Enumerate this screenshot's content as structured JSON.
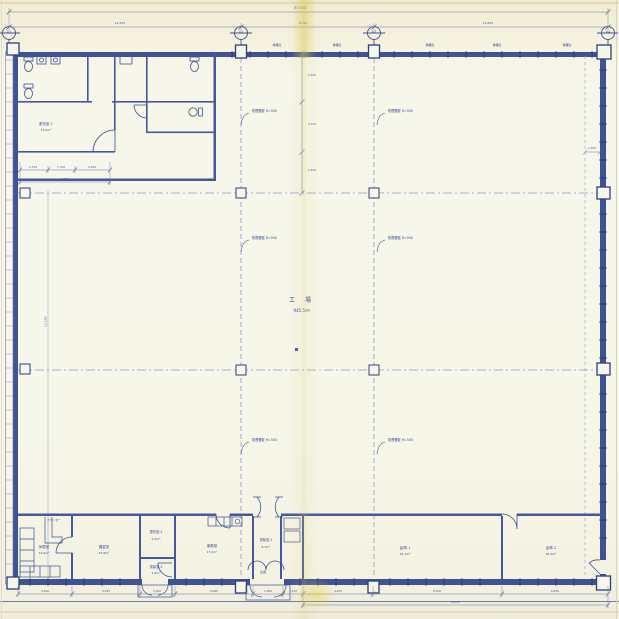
{
  "sheet": {
    "paper_color": "#f6f4e6",
    "ink_color": "#3e5094",
    "wall_color": "#3f5292"
  },
  "grid": {
    "bubbles": [
      {
        "label": "X1"
      },
      {
        "label": "X2"
      },
      {
        "label": "X3"
      },
      {
        "label": "X4"
      }
    ]
  },
  "dims": {
    "overall": "37,540",
    "top": [
      "14,550",
      "8,340",
      "14,650"
    ],
    "block": [
      "1,750",
      "1,700",
      "2,200"
    ],
    "block_total": "5,650",
    "left_chain": [
      "2,950",
      "3,150",
      "2,550"
    ],
    "left_overall": "11,500",
    "eave": "1,500",
    "bottom": [
      "3,400",
      "4,250",
      "2,200",
      "4,900",
      "1,900",
      "1,250",
      "4,400",
      "8,100",
      "6,650"
    ],
    "bottom_total": "19,100"
  },
  "tags": {
    "window": "排煙窓",
    "smoke_barrier": "防煙垂壁 H=500"
  },
  "rooms": {
    "factory": {
      "name": "工  場",
      "area": "945.5m²"
    },
    "locker1": {
      "name": "更衣室-1",
      "area": "13.0m²"
    },
    "rest": {
      "name": "休憩室",
      "area": "14.0m²"
    },
    "training": {
      "name": "講習室",
      "area": "21.8m²"
    },
    "locker2": {
      "name": "更衣室-2",
      "area": "5.0m²"
    },
    "vestibule2": {
      "name": "風除室-2",
      "area": "1.6m²"
    },
    "office": {
      "name": "事務室",
      "area": "17.0m²"
    },
    "vestibule1": {
      "name": "風除室-1",
      "area": "6.7m²"
    },
    "storage1": {
      "name": "倉庫-1",
      "area": "31.1m²"
    },
    "storage2": {
      "name": "倉庫-2",
      "area": "25.4m²"
    },
    "entrance_label": "玄関",
    "counter_label": "カウンター"
  }
}
